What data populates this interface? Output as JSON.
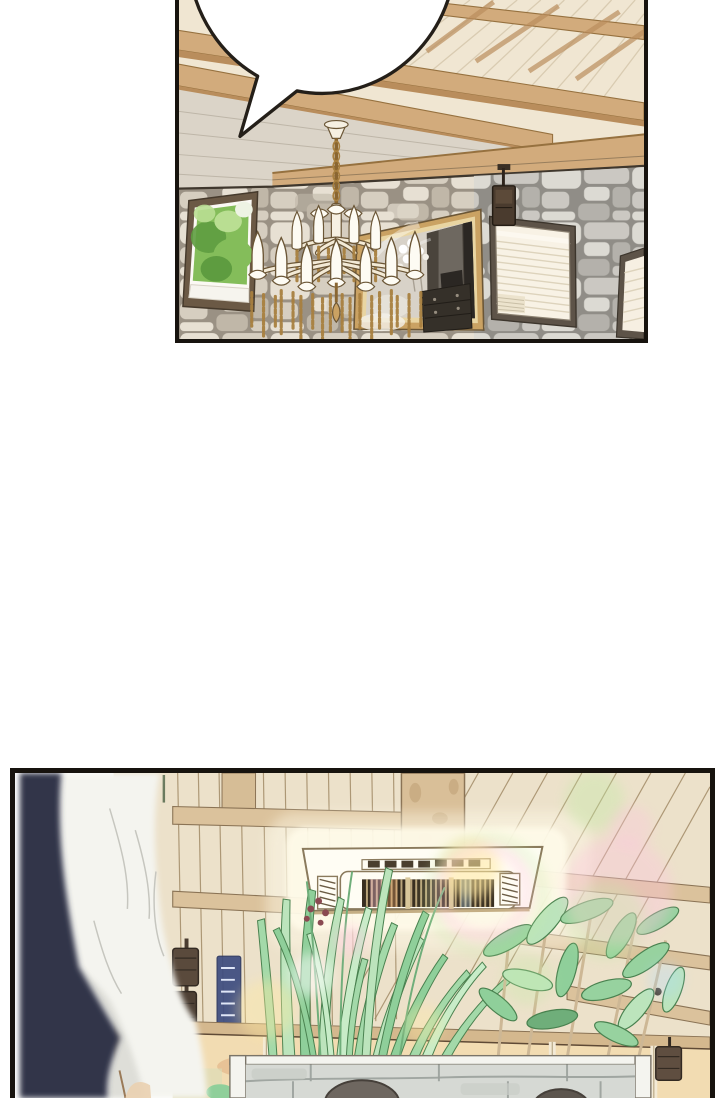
{
  "page": {
    "kind": "webtoon comic page",
    "width_px": 720,
    "height_px": 1098,
    "background": "#ffffff",
    "visible_text": ""
  },
  "panels": [
    {
      "name": "panel-stone-lounge",
      "bounds": {
        "left": 175,
        "top": 0,
        "width": 473,
        "height": 343,
        "cropped_edge": "top"
      },
      "border_color": "#17130e",
      "speech_bubble": {
        "text": "",
        "shape": "white ellipse cropped by top edge of panel",
        "tail": "points down-left",
        "fill": "#ffffff",
        "outline": "#241f19"
      },
      "scene": {
        "ceiling": "plank ceiling with sloping wooden beams",
        "wall": "whitewashed stone masonry wall",
        "left_window": "tilted window with green garden foliage outside",
        "chandelier": "two-tier brass chandelier with white candle lamps and hanging chain tassels",
        "mirror": "large gilt-framed mirror reflecting a dark room with a chest of drawers and white flowers",
        "right_window": "window covered by cream blinds",
        "wall_speaker": "small dark speaker on a mounting arm",
        "far_right_window": "partially visible second blinded window at panel edge"
      }
    },
    {
      "name": "panel-greenhouse-cafe",
      "bounds": {
        "left": 10,
        "top": 768,
        "width": 705,
        "height": 330,
        "cropped_edge": "bottom"
      },
      "border_color": "#17130e",
      "scene": {
        "foreground_figure": "out-of-focus person in a white jacket with dark navy collar seen from behind, left side",
        "ceiling": "slatted wooden ceiling with cross beams and a central square post",
        "ac_unit": "ceiling cassette air conditioner with dark louvre grille glowing with light",
        "plants": "tall grass blades and broad-leaf plants rising in front of a glass wall",
        "planter": "low stone planter wall with white rim",
        "people": "tops of two dark-haired heads behind the planter",
        "speakers": "dark speakers mounted on the glass-wall rails",
        "window_light": "warm evening sky through the glass wall",
        "lens_flares": "rainbow bokeh flare circles over the scene"
      }
    }
  ],
  "palette": {
    "page_bg": "#ffffff",
    "panel_border": "#17130e",
    "ink": "#241f19",
    "bubble_fill": "#ffffff",
    "ceil1": "#f0e6d2",
    "seam1": "#cdbda0",
    "beam": "#d2ab7c",
    "beam_dark": "#b98d5c",
    "beam_line": "#96713f",
    "whitewash": "#dbd4c8",
    "wwline": "#b9b0a2",
    "trim": "#3f372d",
    "mortar": "#9a9184",
    "stone_l": "#e7e0d3",
    "stone_m": "#d6cec0",
    "stone_d": "#c0b7a8",
    "stoneg_l": "#dbd9d3",
    "stoneg_m": "#cac8c2",
    "stoneg_d": "#b3b1ab",
    "wfr": "#6b5945",
    "leaf_l": "#b9de92",
    "leaf_m": "#84bd5a",
    "leaf_d": "#5e9c40",
    "gold": "#c59a58",
    "gold_d": "#8a6631",
    "gold_l": "#a8803f",
    "candle": "#fdfbf3",
    "mirror_frame": "#caa263",
    "mirror_lip": "#e9d5a2",
    "mirror_bg": "#d8d2c8",
    "mirror_dark": "#4a443c",
    "mirror_door": "#2b2723",
    "cab": "#353029",
    "blind": "#f8f2e5",
    "blind_line": "#ddd3bc",
    "frame2": "#5d5348",
    "spk": "#4a3b2e",
    "ceil2": "#ece1ca",
    "line2": "#9c855f",
    "beam2": "#dbc29c",
    "beam2_line": "#8a7355",
    "column": "#d9bf98",
    "mottle": "#bfa276",
    "acw": "#fffdf4",
    "acg_dark": "#382e20",
    "acg_tan": "#c8b184",
    "hatch": "#6b5c44",
    "grass1": "#bce4bc",
    "grass2": "#a3d9a9",
    "grass3": "#8fcf9a",
    "grass4": "#c8ecc8",
    "plant_dark": "#49814f",
    "plant_mid": "#97d29f",
    "stem": "#cdb795",
    "rail": "#d4b88e",
    "rail_dark": "#5f4a36",
    "sky": "#f2dcb2",
    "cloud": "#e4b98c",
    "mull": "#f3ead6",
    "planter": "#d6d9d4",
    "planter_line": "#9aa09b",
    "planter_white": "#f4f4ef",
    "head1": "#6e6760",
    "head2": "#5c554e",
    "head_line": "#46403a",
    "navy": "#303649",
    "jacket": "#f4f4ef",
    "jshadow": "#dcdcd6",
    "jfold": "#c6c6bf",
    "skin": "#ead0b0",
    "jline": "#9a7a58",
    "flare_pink": "#ffc3e0",
    "flare_green": "#c3eba6",
    "flare_cyan": "#aadcff",
    "flare_yellow": "#ffe9a0",
    "glow": "#fffbe9",
    "banner": "#3d4c80",
    "bud": "#8a4a52"
  }
}
